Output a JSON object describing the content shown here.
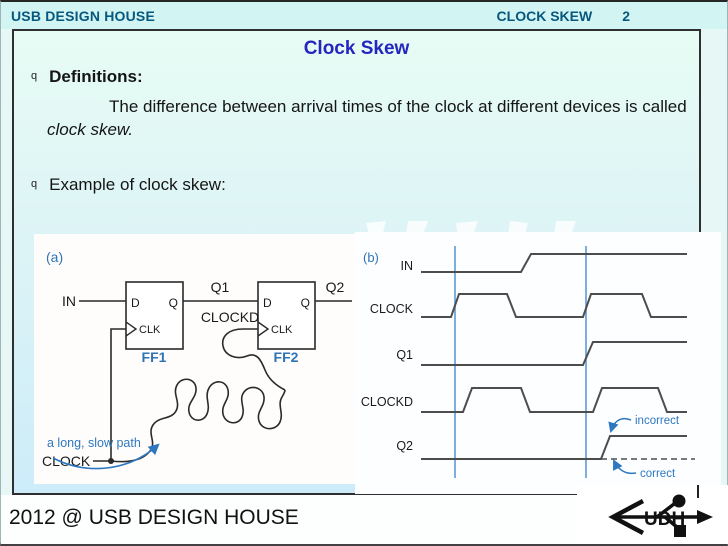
{
  "colors": {
    "header_teal": "#07587e",
    "title_blue": "#2526bf",
    "label_blue": "#2e74b5",
    "waveform_gray": "#4d4d4d",
    "timing_line_blue": "#5b9bd5"
  },
  "header": {
    "company": "USB DESIGN HOUSE",
    "section": "CLOCK SKEW",
    "page_number": "2"
  },
  "slide": {
    "title": "Clock Skew",
    "bullet_marker": "q",
    "definitions_heading": "Definitions:",
    "definition_body": "The difference between arrival times of the clock at different devices is called ",
    "definition_emphasis": "clock skew.",
    "example_heading": "Example of clock skew:"
  },
  "figure_a": {
    "tag": "(a)",
    "in_label": "IN",
    "clock_label": "CLOCK",
    "q1_label": "Q1",
    "q2_label": "Q2",
    "clockd_label": "CLOCKD",
    "d_pin": "D",
    "q_pin": "Q",
    "clk_pin": "CLK",
    "ff1_label": "FF1",
    "ff2_label": "FF2",
    "note": "a long, slow path"
  },
  "figure_b": {
    "tag": "(b)",
    "signals": [
      "IN",
      "CLOCK",
      "Q1",
      "CLOCKD",
      "Q2"
    ],
    "incorrect": "incorrect",
    "correct": "correct"
  },
  "footer": {
    "copyright": "2012 @ USB DESIGN HOUSE",
    "logo_text": "UDH"
  }
}
